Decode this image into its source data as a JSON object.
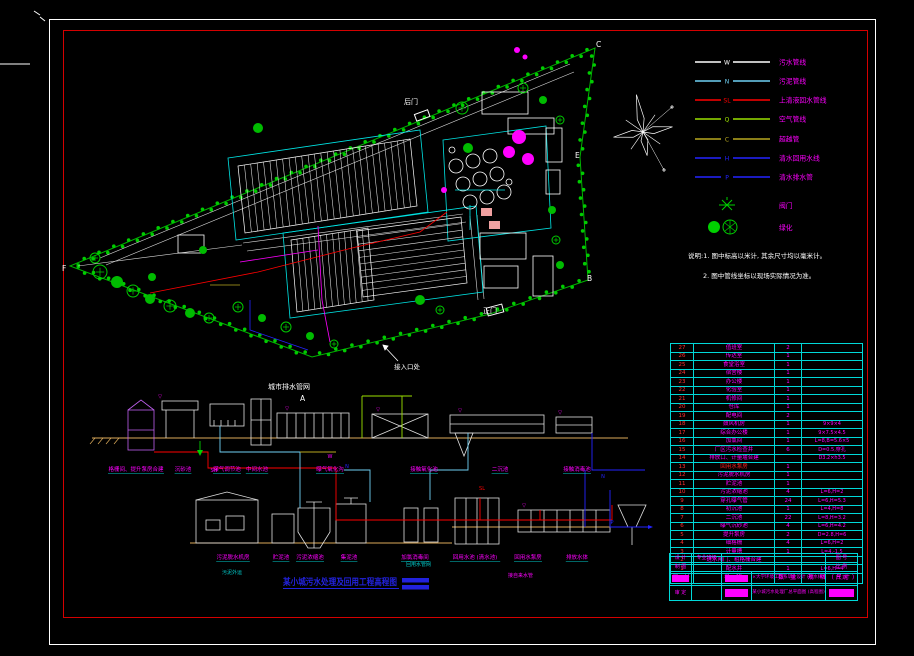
{
  "colors": {
    "background": "#000000",
    "outer_border": "#ffffff",
    "inner_border": "#d40000",
    "table_line": "#00d8d8",
    "label_magenta": "#ff00ff",
    "number_red": "#ff3030",
    "boundary_green": "#00b400",
    "vegetation": "#00cc00",
    "tree_magenta": "#ff00ff",
    "structure_white": "#ffffff",
    "zone_cyan": "#00e5e5",
    "ground_tan": "#dcaa5a",
    "sewage_red": "#ff0000",
    "sludge_cyan": "#6fd1f5",
    "clean_blue": "#2424ff",
    "air_green": "#9be000",
    "bypass_olive": "#b8a820",
    "title_blue": "#2222dd"
  },
  "legend": {
    "items": [
      {
        "name": "sewage-line",
        "label": "污水管线",
        "color": "#ffffff",
        "marker": "W"
      },
      {
        "name": "sludge-line",
        "label": "污泥管线",
        "color": "#6fd1f5",
        "marker": "N"
      },
      {
        "name": "supernatant-line",
        "label": "上清液回水管线",
        "color": "#ff0000",
        "marker": "SL"
      },
      {
        "name": "air-line",
        "label": "空气管线",
        "color": "#9be000",
        "marker": "Q"
      },
      {
        "name": "bypass-line",
        "label": "超越管",
        "color": "#b8a820",
        "marker": "C"
      },
      {
        "name": "reuse-line",
        "label": "清水回用水线",
        "color": "#2424ff",
        "marker": "H"
      },
      {
        "name": "drain-line",
        "label": "清水排水管",
        "color": "#2424ff",
        "marker": "P"
      },
      {
        "name": "valve-symbol",
        "label": "阀门",
        "color": "#00d000",
        "marker": ""
      },
      {
        "name": "greenery-symbol",
        "label": "绿化",
        "color": "#00d000",
        "marker": ""
      }
    ]
  },
  "notes": {
    "line1": "说明:1. 图中标高以米计, 其余尺寸均以毫米计。",
    "line2": "2. 图中管线坐标以现场实际情况为准。"
  },
  "site": {
    "letters": [
      "C",
      "E",
      "B",
      "F",
      "A"
    ],
    "back_gate": "后门",
    "main_gate": "正门",
    "inlet": "接入口处",
    "city_network": "城市排水管网"
  },
  "flow": {
    "upper_labels": [
      "格栅间、提升泵房合建",
      "沉砂池",
      "曝气调节池",
      "中间水池",
      "曝气氧化沟",
      "接触氧化池",
      "二沉池",
      "接触消毒池"
    ],
    "lower_labels": [
      "污泥脱水机房",
      "贮泥池",
      "污泥浓缩池",
      "集泥池",
      "加氯消毒间",
      "回用水池 (清水池)",
      "回用水泵房",
      "排放水体"
    ],
    "markers": [
      "SH",
      "W",
      "N",
      "SL",
      "N",
      "P"
    ],
    "elev_symbol": "▽",
    "tap_water_label": "接自来水管",
    "sludge_out_label": "污泥外运",
    "reuse_net_label": "回用水管网",
    "title": "某小城污水处理及回用工程高程图"
  },
  "table": {
    "headers": {
      "no": "编 号",
      "name": "名 称",
      "qty": "数 量",
      "spec": "规 格 (尺寸)"
    },
    "rows": [
      {
        "no": "27",
        "name": "值班室",
        "qty": "2",
        "spec": ""
      },
      {
        "no": "26",
        "name": "传达室",
        "qty": "1",
        "spec": ""
      },
      {
        "no": "25",
        "name": "食堂浴室",
        "qty": "1",
        "spec": ""
      },
      {
        "no": "24",
        "name": "宿舍楼",
        "qty": "1",
        "spec": ""
      },
      {
        "no": "23",
        "name": "办公楼",
        "qty": "1",
        "spec": ""
      },
      {
        "no": "22",
        "name": "化验室",
        "qty": "1",
        "spec": ""
      },
      {
        "no": "21",
        "name": "机修间",
        "qty": "1",
        "spec": ""
      },
      {
        "no": "20",
        "name": "仓库",
        "qty": "1",
        "spec": ""
      },
      {
        "no": "19",
        "name": "配电间",
        "qty": "2",
        "spec": ""
      },
      {
        "no": "18",
        "name": "鼓风机房",
        "qty": "1",
        "spec": "9×9×4"
      },
      {
        "no": "17",
        "name": "综合办公楼",
        "qty": "1",
        "spec": "9×7.5×4.5"
      },
      {
        "no": "16",
        "name": "加氯间",
        "qty": "1",
        "spec": "L=8,B=5.6×5"
      },
      {
        "no": "15",
        "name": "厂区污水检查井",
        "qty": "6",
        "spec": "D=0.5,穿孔"
      },
      {
        "no": "14",
        "name": "排放口、计量堰合建",
        "qty": "",
        "spec": "D3.2×h3.5"
      },
      {
        "no": "13",
        "name": "回用水泵房",
        "qty": "1",
        "spec": "",
        "hot": true
      },
      {
        "no": "12",
        "name": "污泥脱水机房",
        "qty": "1",
        "spec": ""
      },
      {
        "no": "11",
        "name": "贮泥池",
        "qty": "1",
        "spec": ""
      },
      {
        "no": "10",
        "name": "污泥浓缩池",
        "qty": "4",
        "spec": "L=6,H=2"
      },
      {
        "no": "9",
        "name": "穿孔曝气管",
        "qty": "24",
        "spec": "L=6,H=5.3"
      },
      {
        "no": "8",
        "name": "初沉池",
        "qty": "1",
        "spec": "L=4,H=8"
      },
      {
        "no": "7",
        "name": "二沉池",
        "qty": "22",
        "spec": "L=8,H=3.2"
      },
      {
        "no": "6",
        "name": "曝气沉砂池",
        "qty": "4",
        "spec": "L=6,H=4.2"
      },
      {
        "no": "5",
        "name": "提升泵房",
        "qty": "2",
        "spec": "D=2.8,H=6"
      },
      {
        "no": "4",
        "name": "细格栅",
        "qty": "4",
        "spec": "L=6,H=2"
      },
      {
        "no": "3",
        "name": "计量槽",
        "qty": "1",
        "spec": "L=4,-1.5"
      },
      {
        "no": "2",
        "name": "进水闸门、粗格栅合建",
        "qty": "",
        "spec": ""
      },
      {
        "no": "1",
        "name": "配水井",
        "qty": "1",
        "spec": "L=6,H=4"
      }
    ]
  },
  "title_block": {
    "design": "设 计",
    "draft": "制 图",
    "approve": "审 定",
    "class_label": "专业班级",
    "fig_no": "图 号",
    "scale": "比 例",
    "date": "日 期",
    "org": "××大学环境工程系毕业设计 (给水排水)",
    "drawing": "某小城污水处理厂总平面图 (高程图)"
  }
}
